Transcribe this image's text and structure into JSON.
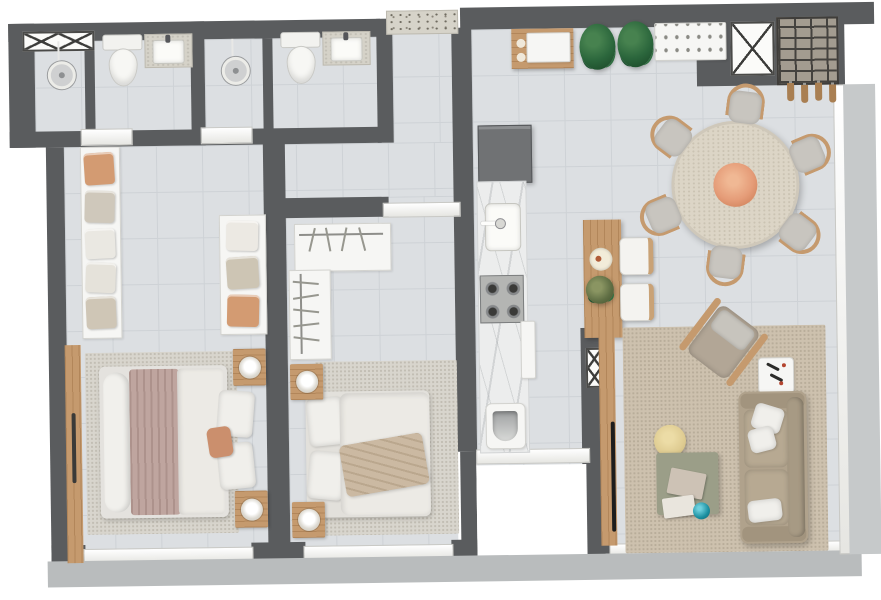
{
  "title": "two-bedroom-apartment-floor-plan-3d-top-view",
  "colors": {
    "wall": "#5a5c5e",
    "floor": "#dcdfe2",
    "tile": "#ced2d6",
    "fixture": "#f6f6f4",
    "wood": "#c59a6e",
    "wood-d": "#a97f52",
    "granite": "#d6d3c9",
    "fridge": "#707274",
    "sofa": "#b0a28c",
    "cushion": "#c8c5bf",
    "mauve": "#bfa59f",
    "duvet": "#eceae5",
    "plant": "#2b663c",
    "coral": "#e59c78",
    "teal": "#1a8fa0",
    "pouf": "#dfcc92",
    "ctable": "#9b9e88",
    "brick": "#a39c90",
    "ledge": "#b9bcbd",
    "balcony": "#c6c9ca",
    "rugliv": "#cdc1ae",
    "rugbed": "#d8d5cd",
    "tv": "#1d1d1d",
    "stone": "#d5d2c8"
  },
  "rooms": [
    {
      "name": "bathroom-1",
      "furniture": [
        "shower-head",
        "linen-shelf-x-doors",
        "toilet",
        "granite-vanity-sink"
      ]
    },
    {
      "name": "bathroom-2",
      "furniture": [
        "shower-head",
        "toilet",
        "granite-vanity-sink"
      ]
    },
    {
      "name": "entry-hall",
      "furniture": [
        "granite-entry-threshold"
      ]
    },
    {
      "name": "walk-in-closet",
      "furniture": [
        "open-wardrobe-left",
        "open-wardrobe-right",
        "folded-clothes-stacks"
      ]
    },
    {
      "name": "master-bedroom",
      "furniture": [
        "double-bed",
        "mauve-blanket",
        "white-duvet",
        "pillows",
        "accent-cushion",
        "nightstand-with-lamp-top",
        "nightstand-with-lamp-bottom",
        "area-rug",
        "wardrobe-sliding-panel",
        "window"
      ]
    },
    {
      "name": "bedroom-2",
      "furniture": [
        "double-bed",
        "white-duvet",
        "tan-throw",
        "pillows",
        "l-shaped-open-wardrobe",
        "clothes-hangers",
        "nightstand-with-lamp-top",
        "nightstand-with-lamp-bottom",
        "area-rug",
        "sliding-door",
        "window"
      ]
    },
    {
      "name": "kitchen",
      "furniture": [
        "refrigerator",
        "marble-counter",
        "sink-with-faucet",
        "gas-cooktop",
        "laundry-tub",
        "service-window",
        "service-void"
      ]
    },
    {
      "name": "island-bar",
      "furniture": [
        "wood-island",
        "stool-x2",
        "decor-plate",
        "plant-sprig",
        "tv-panel-wall",
        "tv"
      ]
    },
    {
      "name": "dining-area",
      "furniture": [
        "round-travertine-table",
        "dining-chair-x6",
        "coral-centerpiece"
      ]
    },
    {
      "name": "living-room",
      "furniture": [
        "sofa",
        "armchair",
        "side-table",
        "coffee-table",
        "books",
        "teal-sphere",
        "yellow-pouf",
        "area-rug"
      ]
    },
    {
      "name": "top-decor-strip",
      "furniture": [
        "wood-console-with-tray",
        "plant-x2",
        "white-buffet-cabinet",
        "shaft-x-box",
        "brick-grill-niche",
        "hanging-utensils-x4"
      ]
    },
    {
      "name": "balcony",
      "furniture": [
        "floor-to-ceiling-window",
        "balcony-floor"
      ]
    }
  ],
  "counts": {
    "bedrooms": 2,
    "bathrooms": 2,
    "dining_chairs": 6,
    "island_stools": 2,
    "plants": 2
  }
}
